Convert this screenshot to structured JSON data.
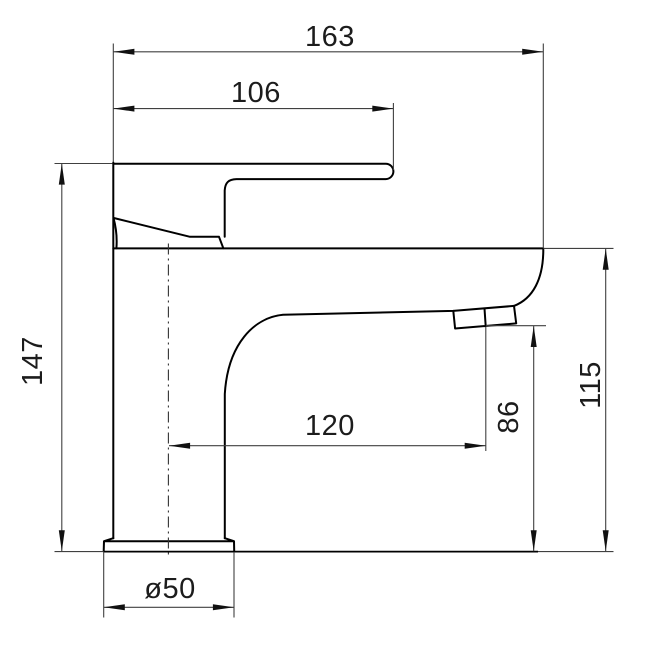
{
  "drawing": {
    "subject": "single-lever basin mixer tap, side elevation technical drawing",
    "units": "mm",
    "colors": {
      "background": "#ffffff",
      "object_line": "#000000",
      "dimension_line": "#404040",
      "text": "#1c1c1c"
    },
    "dimensions": {
      "total_width": "163",
      "handle_length": "106",
      "height_to_handle_top": "147",
      "spout_reach": "120",
      "outlet_height": "86",
      "body_height": "115",
      "base_diameter": "ø50"
    }
  }
}
